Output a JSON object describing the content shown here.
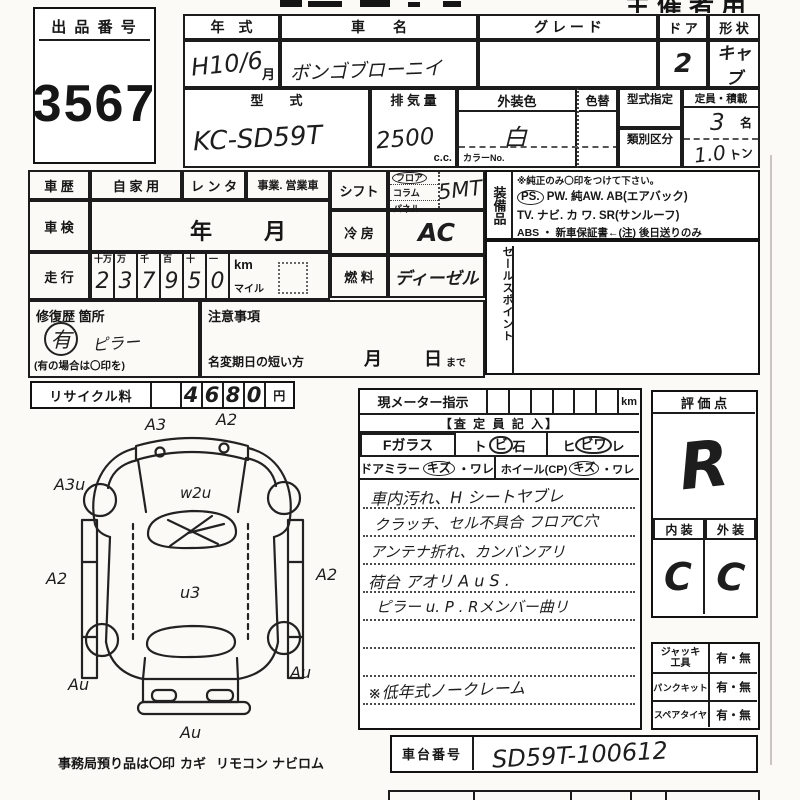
{
  "corner": {
    "label": "主催者用"
  },
  "lot": {
    "label": "出 品 番 号",
    "value": "3567"
  },
  "spec": {
    "year_label": "年　式",
    "year_value": "H10/6",
    "year_unit": "月",
    "name_label": "車　　名",
    "name_value": "ボンゴブローニイ",
    "grade_label": "グ レ ー ド",
    "grade_value": "",
    "door_label": "ド ア",
    "door_value": "2",
    "shape_label": "形 状",
    "shape_value": "キャブ",
    "model_label": "型　　式",
    "model_value": "KC-SD59T",
    "disp_label": "排 気 量",
    "disp_value": "2500",
    "disp_unit": "c.c.",
    "color_label": "外装色",
    "color_value": "白",
    "color_no": "カラーNo.",
    "irogae_label": "色替",
    "type_desig": "型式指定",
    "class_div": "類別区分",
    "capacity_label": "定員・積載",
    "capacity_value": "3",
    "capacity_unit": "名",
    "load_value": "1.0",
    "load_unit": "トン"
  },
  "history": {
    "label": "車 歴",
    "opt1": "自 家 用",
    "opt2": "レ ン タ",
    "opt3": "事業. 営業車",
    "shaken_label": "車 検",
    "shaken_year": "年",
    "shaken_month": "月",
    "run_label": "走 行",
    "dheads": [
      "十万",
      "万",
      "千",
      "百",
      "十",
      "一"
    ],
    "digits": [
      "2",
      "3",
      "7",
      "9",
      "5",
      "0"
    ],
    "km": "km",
    "mile": "マイル",
    "repair_label": "修復歴 箇所",
    "repair_mark": "有",
    "repair_text": "ピラー",
    "repair_hint": "(有の場合は〇印を)",
    "caution_label": "注意事項",
    "rename_label": "名変期日の短い方",
    "rename_month": "月",
    "rename_day": "日",
    "rename_suffix": "まで"
  },
  "drive": {
    "shift_label": "シフト",
    "shift_opt1": "フロア",
    "shift_opt2": "コラム",
    "shift_opt3": "パネル",
    "shift_value": "5MT",
    "ac_label": "冷 房",
    "ac_value": "AC",
    "fuel_label": "燃 料",
    "fuel_value": "ディーゼル"
  },
  "equip": {
    "label": "装備品",
    "note": "※純正のみ〇印をつけて下さい。",
    "ps": "PS.",
    "line1": "PW.  純AW.  AB(エアバック)",
    "line2": "TV.  ナビ.  カ ワ.  SR(サンルーフ)",
    "line3": "ABS ・ 新車保証書←(注) 後日送りのみ"
  },
  "sales": {
    "label": "セールスポイント"
  },
  "recycle": {
    "label": "リサイクル料",
    "d1": "4",
    "d2": "6",
    "d3": "8",
    "d4": "0",
    "unit": "円"
  },
  "meter": {
    "label": "現メーター指示",
    "unit": "km"
  },
  "assess": {
    "header": "【査 定 員 記 入】",
    "fglass": "Fガラス",
    "stone_a": "ト",
    "stone_b": "ビ",
    "stone_c": "石",
    "crack_a": "ヒ",
    "crack_b": "ビワ",
    "crack_c": "レ",
    "mirror": "ドアミラー",
    "mirror_kizu": "キズ",
    "mirror_ware": "・ワレ",
    "wheel": "ホイール(CP)",
    "wheel_kizu": "キズ",
    "wheel_ware": "・ワレ",
    "notes": [
      "車内汚れ、H シートヤブレ",
      "クラッチ、セル不具合 フロアC穴",
      "アンテナ折れ、カンバンアリ",
      "荷台 アオリ A u S .",
      "ピラー u. P . Rメンバー曲リ",
      "※低年式ノークレーム"
    ]
  },
  "eval": {
    "header": "評 価 点",
    "grade": "R",
    "int_label": "内 装",
    "ext_label": "外 装",
    "int_value": "C",
    "ext_value": "C"
  },
  "tools": {
    "rows": [
      {
        "label": "ジャッキ 工具",
        "value": "有・無"
      },
      {
        "label": "パンクキット",
        "value": "有・無"
      },
      {
        "label": "スペアタイヤ",
        "value": "有・無"
      }
    ]
  },
  "chassis": {
    "label": "車台番号",
    "value": "SD59T-100612"
  },
  "diagram": {
    "a3": "A3",
    "a2t": "A2",
    "a3u": "A3u",
    "a2l": "A2",
    "a2r": "A2",
    "w2u": "w2u",
    "u3": "u3",
    "aul": "Au",
    "aur": "Au",
    "aub": "Au"
  },
  "footer": {
    "deposit": "事務局預り品は〇印",
    "item1": "カギ",
    "item2": "リモコン",
    "item3": "ナビロム"
  }
}
